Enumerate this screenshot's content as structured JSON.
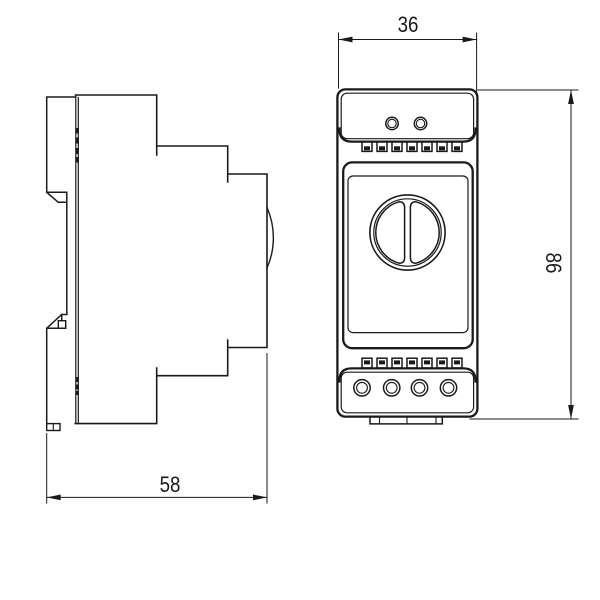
{
  "drawing": {
    "dimensions": {
      "front_width_mm": "36",
      "overall_height_mm": "86",
      "side_depth_mm": "58"
    },
    "colors": {
      "line": "#1a1a1a",
      "background": "#ffffff"
    }
  }
}
